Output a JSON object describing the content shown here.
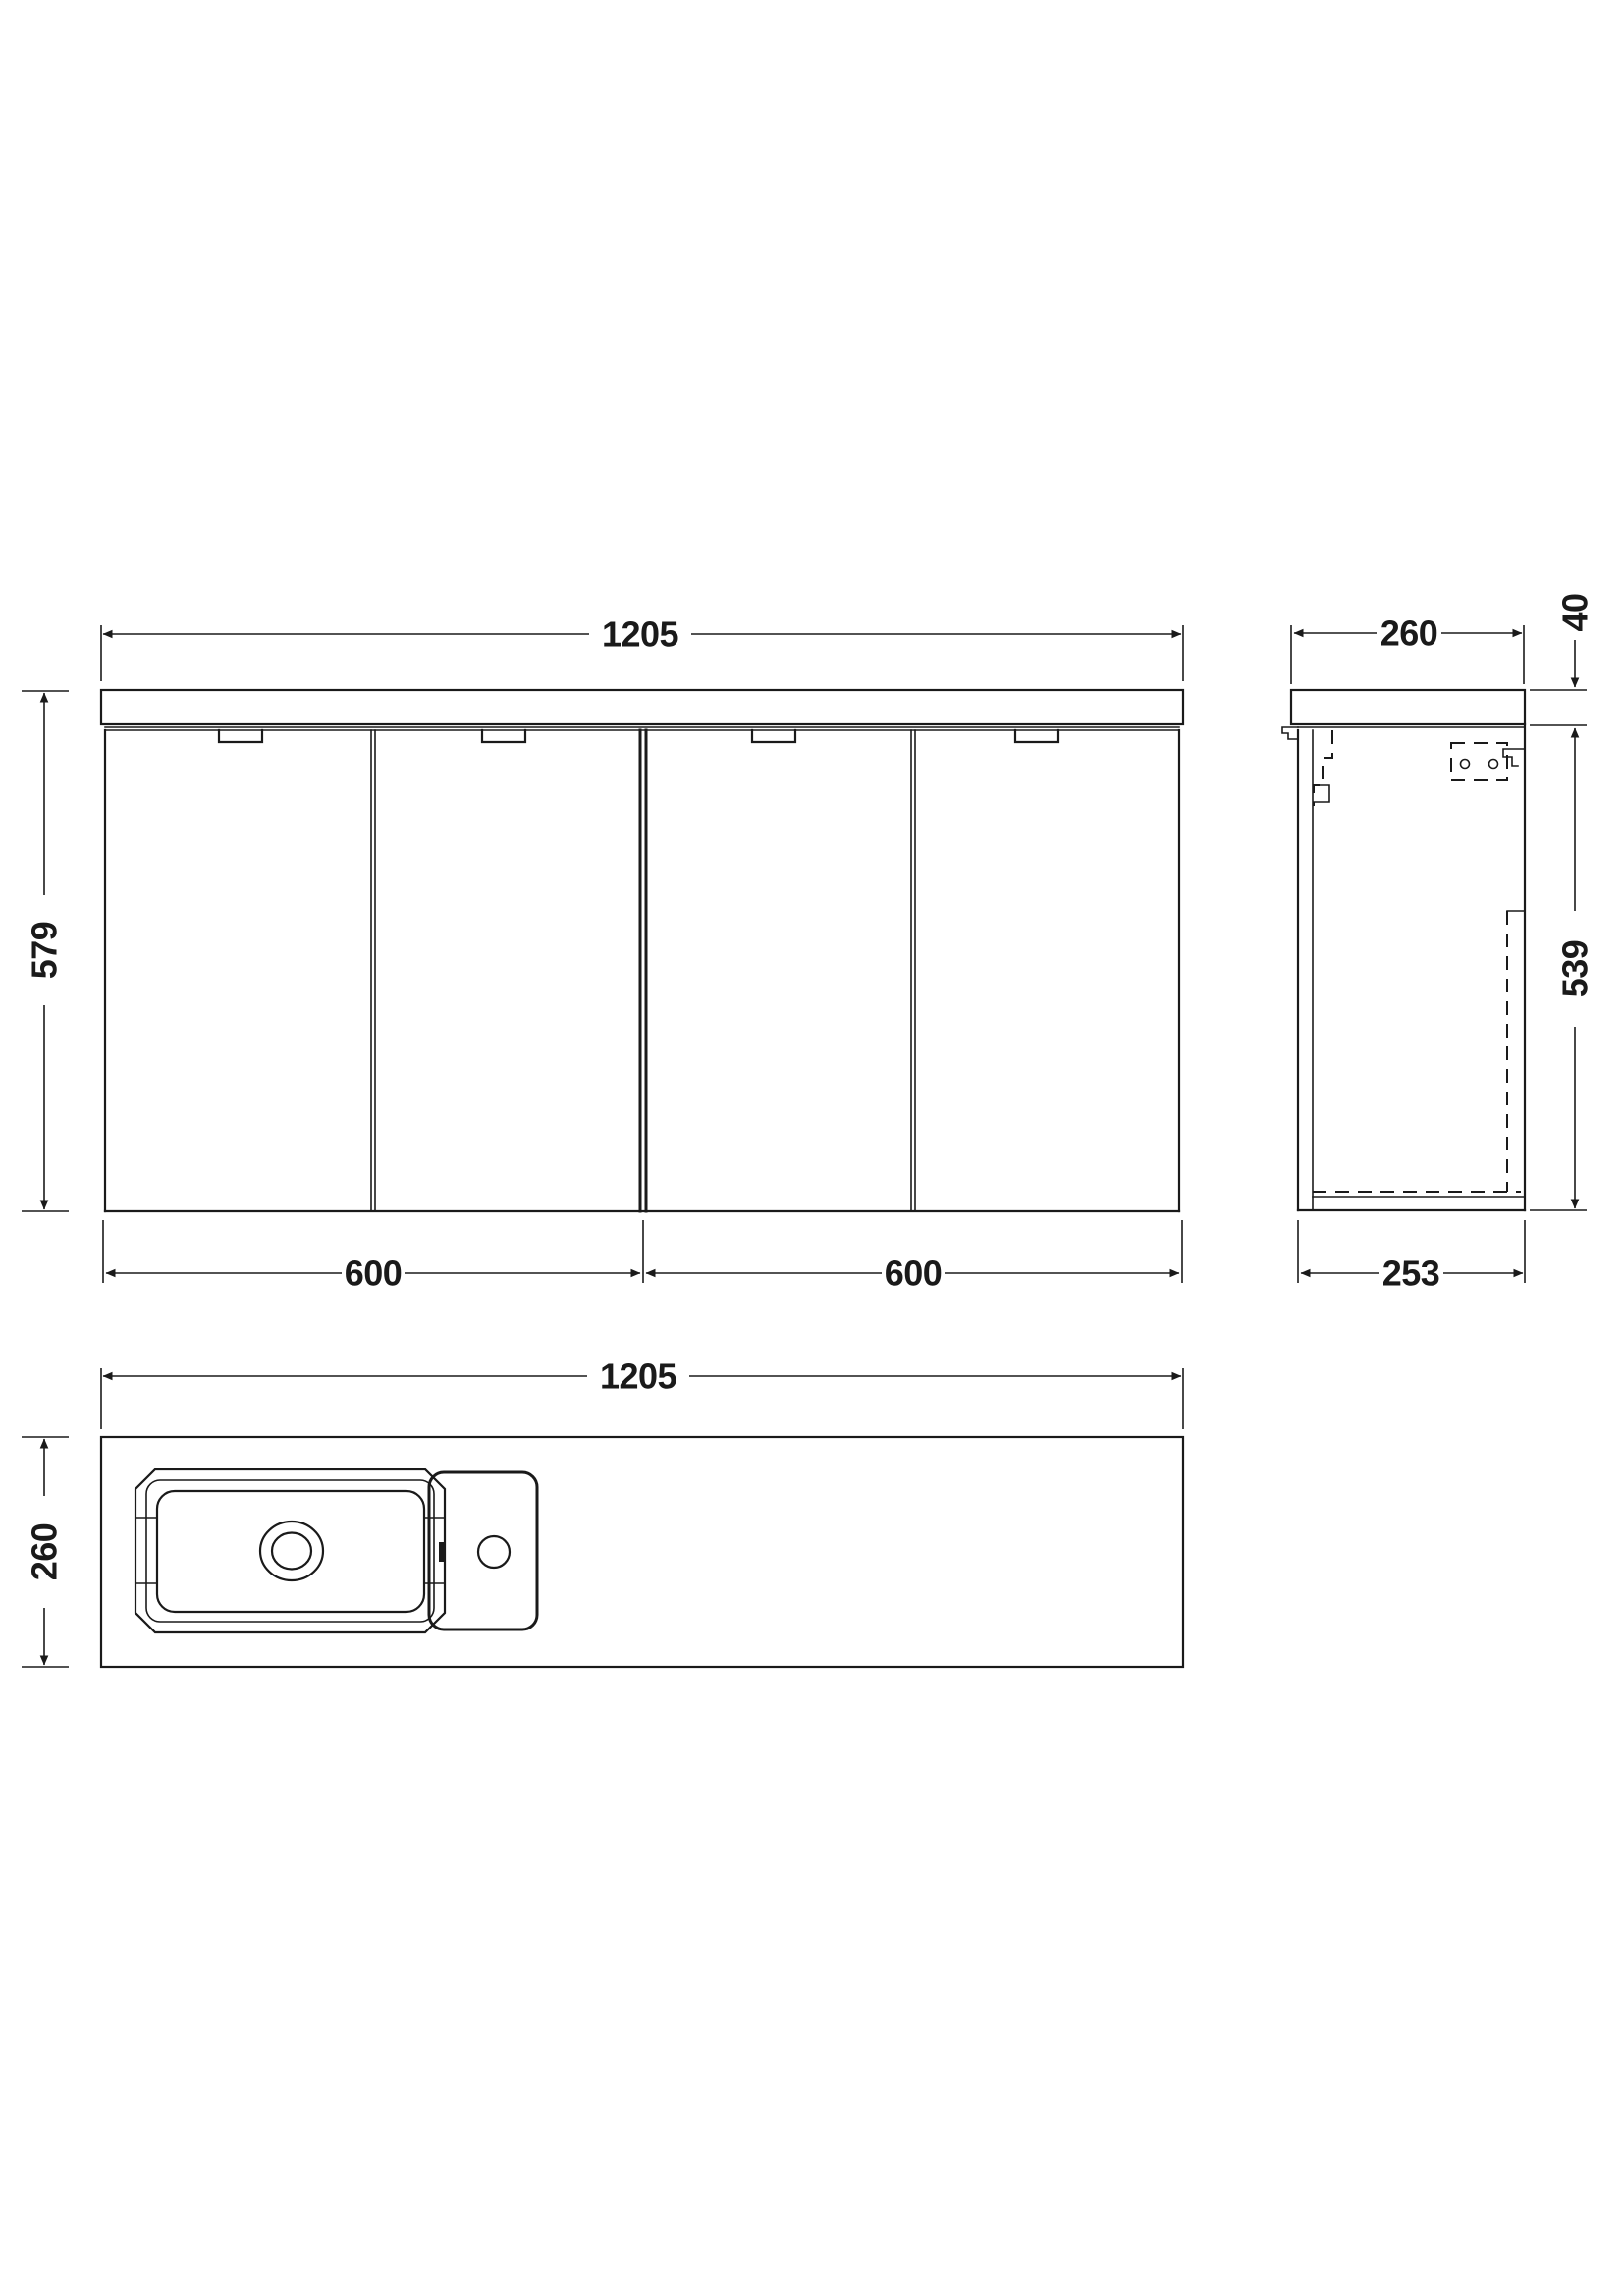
{
  "drawing": {
    "line_color": "#1a1a1a",
    "background": "#ffffff",
    "views": {
      "front": {
        "label": "front-elevation",
        "dim_width": "1205",
        "dim_height": "579",
        "dim_door_left": "600",
        "dim_door_right": "600",
        "door_count": 4
      },
      "side": {
        "label": "side-elevation",
        "dim_depth": "260",
        "dim_worktop_thickness": "40",
        "dim_cabinet_height": "539",
        "dim_cabinet_depth": "253"
      },
      "plan": {
        "label": "plan-view",
        "dim_width": "1205",
        "dim_depth": "260"
      }
    }
  }
}
